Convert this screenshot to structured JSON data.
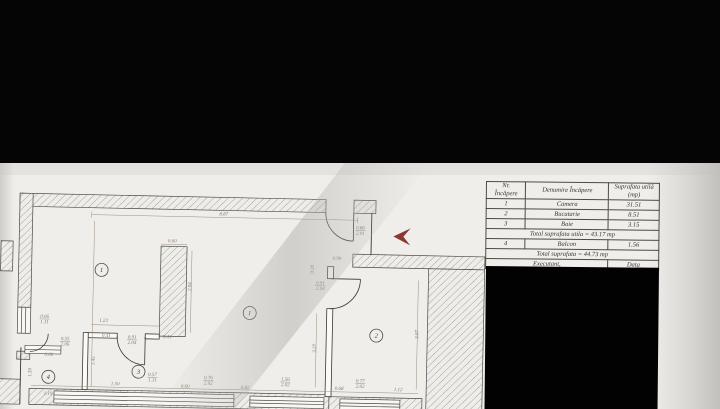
{
  "letterbox_color": "#050505",
  "table": {
    "header": {
      "col1_line1": "Nr.",
      "col1_line2": "Încăpere",
      "col2": "Denumire Încăpere",
      "col3_line1": "Suprafata utilă",
      "col3_line2": "(mp)"
    },
    "rows": [
      {
        "nr": "1",
        "name": "Camera",
        "area": "31.51"
      },
      {
        "nr": "2",
        "name": "Bucatarie",
        "area": "8.51"
      },
      {
        "nr": "3",
        "name": "Baie",
        "area": "3.15"
      }
    ],
    "total_utila": "Total suprafata utila = 43.17 mp",
    "balcon_row": {
      "nr": "4",
      "name": "Balcon",
      "area": "1.56"
    },
    "total": "Total suprafata = 44.73 mp",
    "executant": "Executant,",
    "data_label": "Data"
  },
  "plan": {
    "entrance_arrow_color": "#8d3732",
    "rooms": [
      {
        "num": "1",
        "x": 101,
        "y": 273
      },
      {
        "num": "1",
        "x": 250,
        "y": 313
      },
      {
        "num": "2",
        "x": 377,
        "y": 333
      },
      {
        "num": "3",
        "x": 140,
        "y": 374
      },
      {
        "num": "4",
        "x": 50,
        "y": 381
      }
    ],
    "dimensions": [
      {
        "t": "8.87",
        "x": 222,
        "y": 216
      },
      {
        "t": "0.86",
        "b": "2.01",
        "x": 359,
        "y": 227
      },
      {
        "t": "0.90",
        "x": 336,
        "y": 258
      },
      {
        "t": "0.20",
        "x": 313,
        "y": 268,
        "r": -90
      },
      {
        "t": "0.91",
        "b": "2.04",
        "x": 320,
        "y": 283
      },
      {
        "t": "0.60",
        "x": 171,
        "y": 244
      },
      {
        "t": "2.04",
        "x": 191,
        "y": 288,
        "r": -90
      },
      {
        "t": "1.23",
        "x": 104,
        "y": 325
      },
      {
        "t": "0.41",
        "x": 107,
        "y": 340
      },
      {
        "t": "0.41",
        "x": 168,
        "y": 340
      },
      {
        "t": "0.91",
        "b": "2.04",
        "x": 133,
        "y": 341
      },
      {
        "t": "0.66",
        "b": "1.11",
        "x": 45,
        "y": 322
      },
      {
        "t": "0.55",
        "b": "2.06",
        "x": 66,
        "y": 344
      },
      {
        "t": "0.06",
        "x": 50,
        "y": 360
      },
      {
        "t": "1.45",
        "x": 96,
        "y": 364,
        "r": -90
      },
      {
        "t": "1.39",
        "x": 33,
        "y": 377,
        "r": -90
      },
      {
        "t": "1.19",
        "x": 50,
        "y": 399
      },
      {
        "t": "1.50",
        "x": 117,
        "y": 388
      },
      {
        "t": "0.57",
        "b": "1.11",
        "x": 154,
        "y": 378
      },
      {
        "t": "0.60",
        "x": 187,
        "y": 389
      },
      {
        "t": "0.76",
        "b": "2.02",
        "x": 210,
        "y": 380
      },
      {
        "t": "0.82",
        "x": 247,
        "y": 389
      },
      {
        "t": "1.56",
        "b": "2.02",
        "x": 287,
        "y": 380
      },
      {
        "t": "0.68",
        "x": 341,
        "y": 388
      },
      {
        "t": "0.77",
        "b": "2.02",
        "x": 362,
        "y": 380
      },
      {
        "t": "1.12",
        "x": 400,
        "y": 388
      },
      {
        "t": "3.27",
        "x": 317,
        "y": 347,
        "r": -90
      },
      {
        "t": "3.07",
        "x": 419,
        "y": 331,
        "r": -90
      }
    ]
  }
}
